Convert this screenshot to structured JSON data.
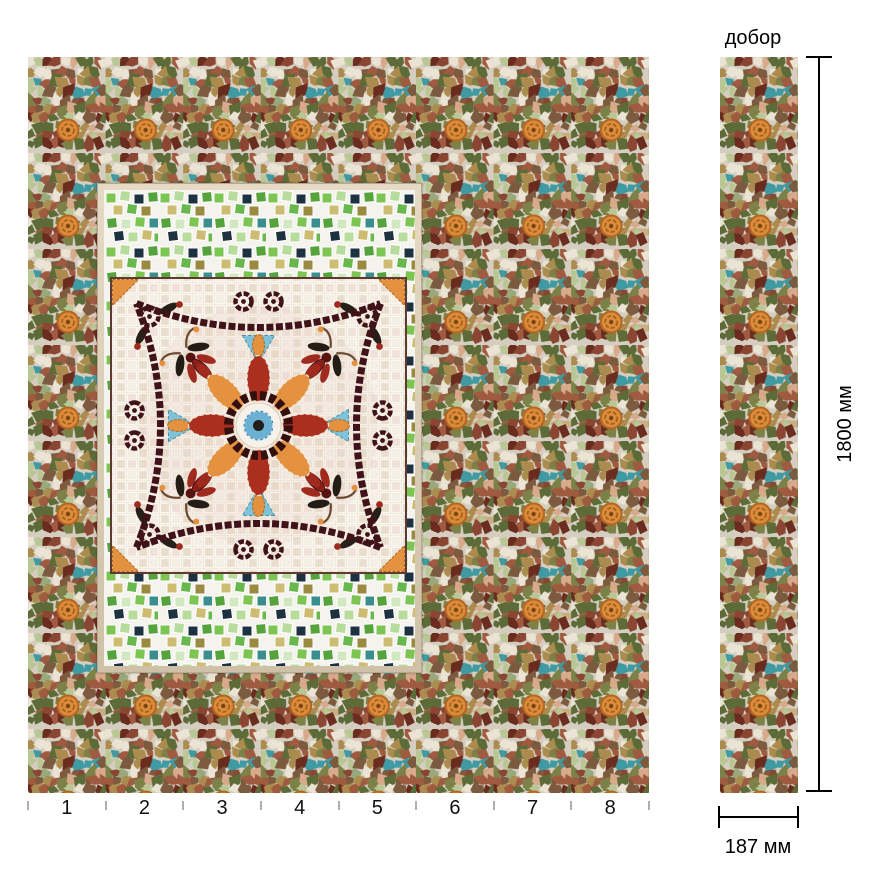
{
  "annotations": {
    "strip_label": "добор",
    "height_label": "1800 мм",
    "width_label": "187 мм"
  },
  "ruler": {
    "numbers": [
      "1",
      "2",
      "3",
      "4",
      "5",
      "6",
      "7",
      "8"
    ],
    "sections": 8
  },
  "palette": {
    "grout": "#d5cec0",
    "terracotta": "#a05a40",
    "brick": "#8a4632",
    "dark_red": "#6b2c20",
    "olive": "#7c8148",
    "moss": "#5c6b38",
    "light_green": "#b9c795",
    "sage": "#9aa87e",
    "cream": "#ebe4d4",
    "tan": "#c9ae84",
    "salmon": "#d9a98c",
    "gold": "#ab8c4e",
    "brown": "#7c5a3e",
    "teal": "#3f9aa4",
    "light_teal": "#85d3d8",
    "deep_teal": "#2f7f86",
    "orange": "#d98c3c",
    "medallion_dark": "#40121a",
    "medallion_red": "#ab2f1f",
    "medallion_orange": "#e49140",
    "medallion_blue": "#6cb1d4",
    "band_green": "#7cc553",
    "band_navy": "#1d3140"
  }
}
